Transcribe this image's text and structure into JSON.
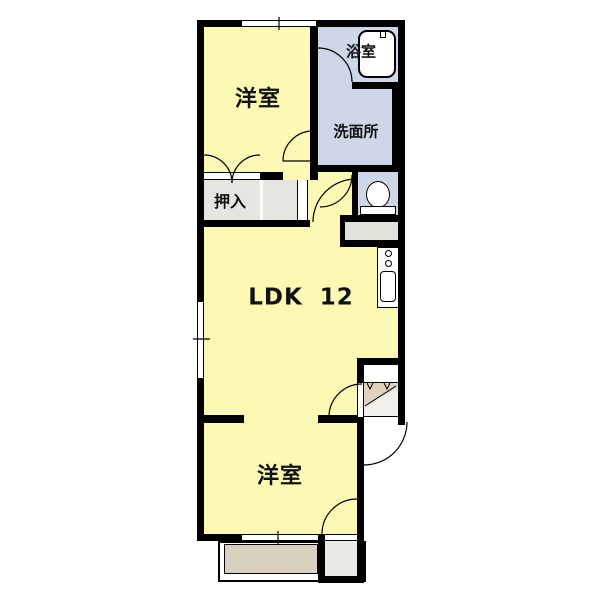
{
  "plan": {
    "rooms": {
      "bedroom_top": "洋室",
      "bath": "浴室",
      "washroom": "洗面所",
      "closet": "押入",
      "ldk": "LDK 12",
      "bedroom_bottom": "洋室"
    },
    "colors": {
      "room_floor": "#FBF9B4",
      "wet_area": "#CDD7E7",
      "closet_floor": "#E6E5E0",
      "balcony": "#D9D0BF",
      "genkan_step": "#DFD3BD",
      "wall": "#000000",
      "background": "#FFFFFF"
    }
  }
}
